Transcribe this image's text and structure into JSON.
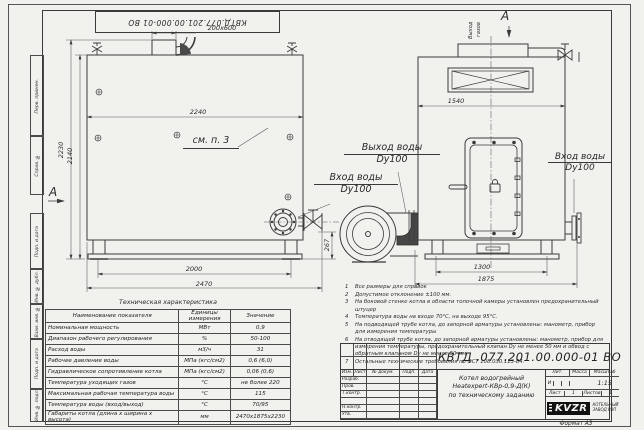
{
  "sheet": {
    "corner_number": "КВТД.077.201.00.000-01 ВО",
    "format_note": "Формат А3",
    "margin_boxes": [
      "Перв. примен.",
      "Справ. №",
      "Подп. и дата",
      "Инв. № дубл.",
      "Взам. инв. №",
      "Подп. и дата",
      "Инв. № подл."
    ]
  },
  "labels": {
    "see_note": "см. п. 3",
    "water_outlet": "Выход воды",
    "water_outlet_dn": "Dy100",
    "water_inlet": "Вход воды",
    "water_inlet_dn": "Dy100",
    "water_inlet_right": "Вход воды",
    "water_inlet_right_dn": "Dy100",
    "gas_outlet_1": "Выход",
    "gas_outlet_2": "газов",
    "view_a": "А",
    "section_a": "А",
    "chimney_size": "200х600"
  },
  "dims": {
    "body_length": "2240",
    "total_height": "2230",
    "body_height": "2140",
    "skid_length": "2000",
    "total_length": "2470",
    "inlet_height": "267",
    "front_width": "1540",
    "front_skid_width": "1300",
    "total_width": "1875"
  },
  "tech_table": {
    "title": "Техническая характеристика",
    "headers": [
      "Наименование показателя",
      "Единицы измерения",
      "Значение"
    ],
    "rows": [
      [
        "Номинальная мощность",
        "МВт",
        "0,9"
      ],
      [
        "Диапазон рабочего регулирования",
        "%",
        "50-100"
      ],
      [
        "Расход воды",
        "м3/ч",
        "31"
      ],
      [
        "Рабочее давление воды",
        "МПа (кгс/см2)",
        "0,6 (6,0)"
      ],
      [
        "Гидравлическое сопротивление котла",
        "МПа (кгс/см2)",
        "0,06 (0,6)"
      ],
      [
        "Температура уходящих газов",
        "°С",
        "не более 220"
      ],
      [
        "Максимальная рабочая температура воды",
        "°С",
        "115"
      ],
      [
        "Температура воды (вход/выход)",
        "°С",
        "70/95"
      ],
      [
        "Габариты котла (длина х ширина х высота)",
        "мм",
        "2470х1875х2230"
      ]
    ]
  },
  "notes": [
    "Все размеры для справок",
    "Допустимое отклонение ±100 мм.",
    "На боковой стенке котла в области топочной камеры установлен предохранительный штуцер",
    "Температура воды на входе 70°С, на выходе 95°С.",
    "На подводящей трубе котла, до запорной арматуры установлены: манометр, прибор для измерения температуры",
    "На отводящей трубе котла, до запорной арматуры установлены: манометр, прибор для измерения температуры, предохранительный клапан Dy не менее 50 мм и обвод с обратным клапаном Dy не менее 50 мм.",
    "Остальные технические требования по ОСТ 108.030.113-84."
  ],
  "stamp": {
    "doc_number": "КВТД .077.201.00.000-01 ВО",
    "title_lines": [
      "Котел водогрейный",
      "Heatexpert-КВр-0,9-Д(К)",
      "по техническому заданию"
    ],
    "headers": {
      "lit": "Лит.",
      "mass": "Масса",
      "scale": "Масштаб",
      "sheet": "Лист",
      "sheets": "Листов"
    },
    "lit_value": "И",
    "scale_value": "1:15",
    "sheet_no": "1",
    "sheets_no": "1",
    "sign_cols": [
      "Изм.",
      "Лист",
      "№ докум.",
      "Подп.",
      "Дата"
    ],
    "sign_rows": [
      "Разраб.",
      "Пров.",
      "Т.контр.",
      "",
      "Н.контр.",
      "Утв."
    ],
    "logo_text": "KVZR",
    "logo_caption_1": "КОТЕЛЬНЫЙ",
    "logo_caption_2": "ЗАВОД РЭП"
  }
}
